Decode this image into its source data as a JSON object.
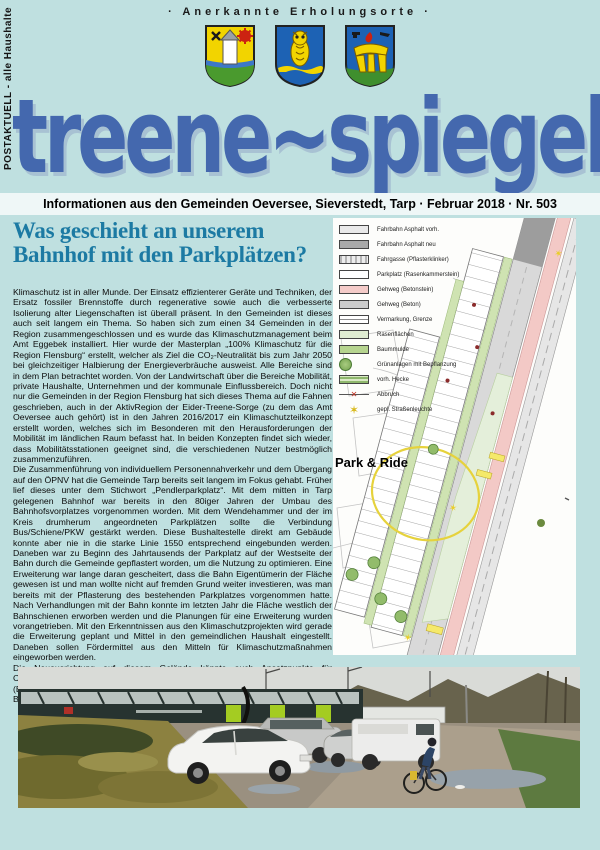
{
  "page": {
    "background": "#bfe0e0",
    "accent_blue": "#4468ae",
    "headline_color": "#1c7aa3"
  },
  "masthead": {
    "postal_label": "POSTAKTUELL - alle Haushalte",
    "ribbon": "·  Anerkannte Erholungsorte  ·",
    "title": "treene~spiegel",
    "crests": [
      "church-and-gear-crest",
      "owl-crest",
      "dolmen-and-flame-crest"
    ]
  },
  "info_line": "Informationen aus den Gemeinden Oeversee, Sieverstedt, Tarp · Februar 2018 · Nr. 503",
  "article": {
    "headline": "Was geschieht an unserem Bahnhof mit den Parkplätzen?",
    "paragraphs": {
      "p1": "Klimaschutz ist in aller Munde. Der Einsatz effizienterer Geräte und Techniken, der Ersatz fossiler Brennstoffe durch regenerative sowie auch die verbesserte Isolierung alter Liegenschaften ist überall präsent. In den Gemeinden ist dieses auch seit langem ein Thema. So haben sich zum einen 34 Gemeinden in der Region zusammengeschlossen und es wurde das Klimaschutzmanagement beim Amt Eggebek installiert. Hier wurde der Masterplan „100% Klimaschutz für die Region Flensburg“ erstellt, welcher als Ziel die CO₂-Neutralität bis zum Jahr 2050 bei gleichzeitiger Halbierung der Energieverbräuche ausweist. Alle Bereiche sind in dem Plan betrachtet worden. Von der Landwirtschaft über die Bereiche Mobilität, private Haushalte, Unternehmen und der kommunale Einflussbereich. Doch nicht nur die Gemeinden in der Region Flensburg hat sich dieses Thema auf die Fahnen geschrieben, auch in der AktivRegion der Eider-Treene-Sorge (zu dem das Amt Oeversee auch gehört) ist in den Jahren 2016/2017 ein Klimaschutzteilkonzept erstellt worden, welches sich im Besonderen mit den Herausforderungen der Mobilität im ländlichen Raum befasst hat. In beiden Konzepten findet sich wieder, dass Mobilitätsstationen geeignet sind, die verschiedenen Nutzer bestmöglich zusammenzuführen.",
      "p2": "Die Zusammenführung von individuellem Personennahverkehr und dem Übergang auf den ÖPNV hat die Gemeinde Tarp bereits seit langem im Fokus gehabt. Früher lief dieses unter dem Stichwort „Pendlerparkplatz“. Mit dem mitten in Tarp gelegenen Bahnhof war bereits in den 80iger Jahren der Umbau des Bahnhofsvorplatzes vorgenommen worden. Mit dem Wendehammer und der im Kreis drumherum angeordneten Parkplätzen sollte die Verbindung Bus/Schiene/PKW gestärkt werden. Diese Bushaltestelle direkt am Gebäude konnte aber nie in die starke Linie 1550 entsprechend eingebunden werden. Daneben war zu Beginn des Jahrtausends der Parkplatz auf der Westseite der Bahn durch die Gemeinde gepflastert worden, um die Nutzung zu optimieren. Eine Erweiterung war lange daran gescheitert, dass die Bahn Eigentümerin der Fläche gewesen ist und man wollte nicht auf fremden Grund weiter investieren, was man bereits mit der Pflasterung des bestehenden Parkplatzes vorgenommen hatte. Nach Verhandlungen mit der Bahn konnte im letzten Jahr die Fläche westlich der Bahnschienen erworben werden und die Planungen für eine Erweiterung wurden vorangetrieben. Mit den Erkenntnissen aus den Klimaschutzprojekten wird gerade die Erweiterung geplant und Mittel in den gemeindlichen Haushalt eingestellt. Daneben sollen Fördermittel aus den Mitteln für Klimaschutzmaßnahmen eingeworben werden.",
      "p3": "Die Neuausrichtung auf diesem Gelände könnte auch Ansatzpunkte für Carsharingmodelle oder auch eine Verbindung mit dem EMONO-Projekt (Elektrisch mobil zwischen Nord- und Ostsee) der Gebietsgemeinschaft Grünes Binnenland bilden."
    }
  },
  "map": {
    "label": "Park & Ride",
    "legend": [
      {
        "type": "sw-asphalt-old",
        "icon": "asphalt-existing-swatch",
        "label": "Fahrbahn Asphalt vorh."
      },
      {
        "type": "sw-asphalt-new",
        "icon": "asphalt-new-swatch",
        "label": "Fahrbahn Asphalt neu"
      },
      {
        "type": "sw-paver",
        "icon": "paver-lane-swatch",
        "label": "Fahrgasse (Pflasterklinker)"
      },
      {
        "type": "sw-white",
        "icon": "parking-swatch",
        "label": "Parkplatz (Rasenkammerstein)"
      },
      {
        "type": "sw-pink",
        "icon": "sidewalk-new-swatch",
        "label": "Gehweg (Betonstein)"
      },
      {
        "type": "sw-gray",
        "icon": "sidewalk-existing-swatch",
        "label": "Gehweg (Beton)"
      },
      {
        "type": "sw-mark",
        "icon": "boundary-swatch",
        "label": "Vermarkung, Grenze"
      },
      {
        "type": "sw-lawn",
        "icon": "lawn-swatch",
        "label": "Rasenflächen"
      },
      {
        "type": "sw-pit",
        "icon": "tree-pit-swatch",
        "label": "Baummulde"
      },
      {
        "type": "sw-tree",
        "icon": "tree-icon",
        "label": "Grünanlagen mit Bepflanzung"
      },
      {
        "type": "sw-hedge",
        "icon": "hedge-swatch",
        "label": "vorh. Hecke"
      },
      {
        "type": "sw-abbruch",
        "icon": "demolition-x-icon",
        "glyph": "✕",
        "label": "Abbruch"
      },
      {
        "type": "sw-star",
        "icon": "streetlight-star-icon",
        "glyph": "✶",
        "label": "gepl. Straßenleuchte"
      }
    ]
  }
}
